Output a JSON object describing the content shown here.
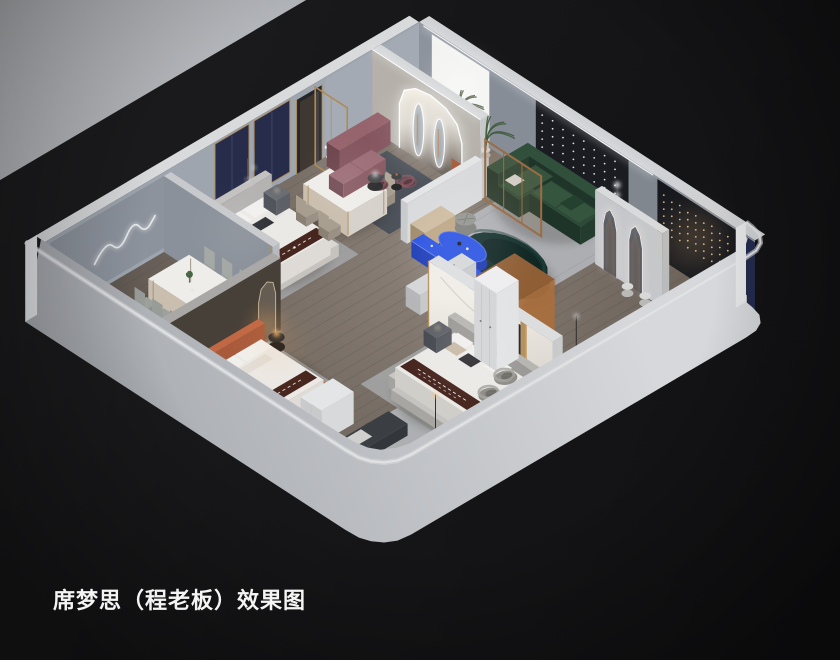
{
  "caption": {
    "text": "席梦思（程老板）效果图",
    "color": "#f4f4f4"
  },
  "palette": {
    "background": "#161618",
    "background_light": "#1e1e20",
    "background_dark": "#111113",
    "outer_wall": "#b6b9be",
    "outer_wall_light": "#d6d8db",
    "wall_top": "#e2e4e6",
    "inner_wall": "#9ea5ae",
    "inner_wall_dark": "#8d939d",
    "charcoal_panel": "#1a1c21",
    "charcoal_panel_2": "#16181d",
    "navy_panel": "#232b4d",
    "navy_drape": "#262c49",
    "gold_trim": "#b08a55",
    "marble": "#ece9e3",
    "wood_floor": "#6e655d",
    "floor_shadow": "#4a443f",
    "plank_line": "#524b45",
    "rug_light": "#b2b5ba",
    "rug_dark": "#4a5058",
    "bed_white": "#ebe9e6",
    "runner_brown": "#47261f",
    "accent_blue": "#2a52e2",
    "sofa_teal": "#16312d",
    "sofa_green": "#2c4a37",
    "bench_mauve": "#9d6e77",
    "chair_plum": "#7c515b",
    "bed_orange": "#b2603e",
    "chair_greige": "#a89e90",
    "tub_chair_gray": "#8f8d88",
    "wood_frame": "#9a6c44",
    "warm_glow": "#ffc27a",
    "led_white": "#ffffff",
    "string_light_warm": "#f2c98f",
    "display_box_amber": "#c08049"
  }
}
